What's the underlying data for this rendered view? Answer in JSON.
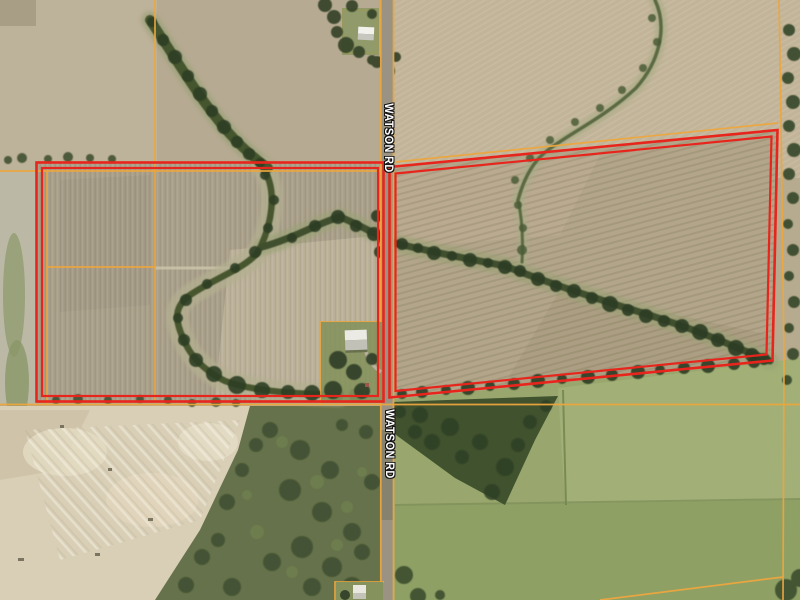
{
  "map": {
    "road_labels": [
      {
        "id": "top",
        "text": "WATSON RD"
      },
      {
        "id": "bottom",
        "text": "WATSON RD"
      }
    ],
    "colors": {
      "boundary_red": "#e8251c",
      "parcel_orange": "#eda63e",
      "road_gray": "#9a9384",
      "label_text": "#ffffff",
      "label_outline": "#141414"
    }
  }
}
